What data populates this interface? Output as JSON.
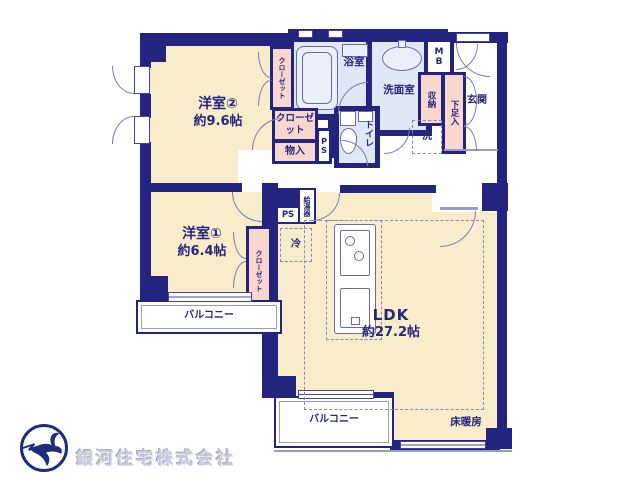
{
  "company": {
    "name": "銀河住宅株式会社"
  },
  "rooms": {
    "western2": {
      "name": "洋室②",
      "size": "約9.6帖"
    },
    "western1": {
      "name": "洋室①",
      "size": "約6.4帖"
    },
    "ldk": {
      "name": "LDK",
      "size": "約27.2帖"
    },
    "bathroom": "浴室",
    "washroom": "洗面室",
    "toilet": "トイレ",
    "entrance": "玄関"
  },
  "features": {
    "closet_west2": "クローゼット",
    "closet_hall": "クローゼット",
    "closet_west1": "クローゼット",
    "storage": "物入",
    "shoe_cabinet": "下足入",
    "cabinet": "収納",
    "washer": "洗",
    "fridge": "冷",
    "water_heater": "給湯器",
    "pipe_space_hall": "PS",
    "pipe_space_ldk": "PS",
    "meter_box": "MB",
    "balcony_west": "バルコニー",
    "balcony_south": "バルコニー",
    "floor_heating": "床暖房"
  },
  "colors": {
    "wall": "#232380",
    "room_cream": "#f8ecca",
    "wet_area_blue": "#dfe9f6",
    "closet_pink": "#f8d7cf",
    "fixture_line": "#6a6aa5",
    "text_navy": "#26267d",
    "logo_gray": "#c9cbdb"
  }
}
